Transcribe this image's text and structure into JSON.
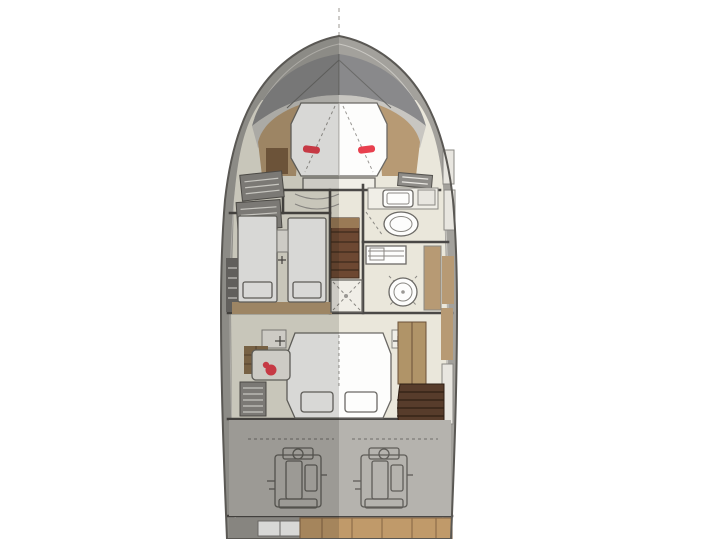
{
  "plan": {
    "kind": "yacht-lower-deck-floor-plan",
    "view": "top-down",
    "orientation": "bow-up",
    "centerline_dashed": true
  },
  "colors": {
    "background": "#ffffff",
    "hull_outline": "#5a5854",
    "hull_band": "#a3a19c",
    "hull_inner_line": "#cac8c3",
    "bow_deck": "#89898b",
    "bow_arc": "#c8c6c1",
    "floor": "#eae7db",
    "wall": "#4a4846",
    "furniture_white": "#fdfdfc",
    "furniture_cream": "#f0eee7",
    "wood_tan": "#b79a74",
    "wood_dark": "#7c5f41",
    "stairs_brown": "#6d4832",
    "stairs_landing": "#9a7a56",
    "stairs_dark": "#573c2b",
    "louver_gray": "#8e8c88",
    "locker_dark": "#6f6d6a",
    "accent_red": "#e8404e",
    "engine_floor": "#b5b3ae",
    "engine_outline": "#5f5d59",
    "stern_strip": "#9c9a95",
    "platform_wood": "#c09a6a",
    "shadow_overlay": "rgba(25,22,18,0.16)",
    "centerline": "#b9b7b2",
    "panel_white": "#e8e6e0",
    "wardrobe_tan": "#b09468",
    "cabinet_brown": "#8a6f4e"
  },
  "areas": [
    {
      "id": "foredeck",
      "name": "foredeck"
    },
    {
      "id": "forward-cabin",
      "name": "forward-vip-cabin-island-berth"
    },
    {
      "id": "guest-cabin",
      "name": "twin-guest-cabin-port"
    },
    {
      "id": "forward-head",
      "name": "forward-head-starboard"
    },
    {
      "id": "mid-head",
      "name": "mid-head-with-shower"
    },
    {
      "id": "companionway",
      "name": "central-companionway-stairs"
    },
    {
      "id": "shower-cabin",
      "name": "central-shower"
    },
    {
      "id": "master-cabin",
      "name": "master-cabin-double-berth"
    },
    {
      "id": "aft-stairs",
      "name": "aft-curved-stairs"
    },
    {
      "id": "engine-room",
      "name": "engine-room-twin-engines"
    },
    {
      "id": "swim-platform",
      "name": "stern-swim-platform"
    }
  ],
  "counts": {
    "double_berths": 2,
    "single_berths": 2,
    "heads": 2,
    "engines": 2,
    "red_pillows": 2
  }
}
